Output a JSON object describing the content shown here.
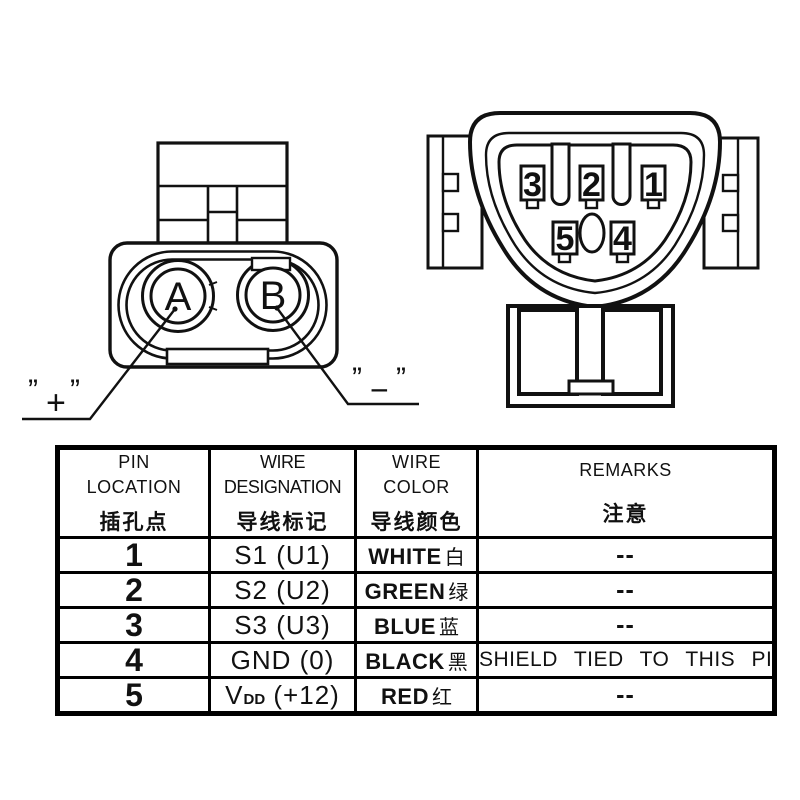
{
  "connector_2pin": {
    "pin_a": "A",
    "pin_b": "B",
    "positive": {
      "open_quote": "”",
      "sign": "+",
      "close_quote": "”"
    },
    "negative": {
      "open_quote": "”",
      "sign": "−",
      "close_quote": "”"
    }
  },
  "connector_5pin": {
    "pins": [
      "3",
      "2",
      "1",
      "5",
      "4"
    ]
  },
  "table": {
    "headers": [
      {
        "en": "PIN\nLOCATION",
        "zh": "插孔点"
      },
      {
        "en": "WIRE\nDESIGNATION",
        "zh": "导线标记"
      },
      {
        "en": "WIRE\nCOLOR",
        "zh": "导线颜色"
      },
      {
        "en": "REMARKS",
        "zh": "注意"
      }
    ],
    "rows": [
      {
        "pin": "1",
        "designation": "S1 (U1)",
        "designation_sub": "",
        "designation_post": "",
        "color_en": "WHITE",
        "color_zh": "白",
        "remarks": "--"
      },
      {
        "pin": "2",
        "designation": "S2 (U2)",
        "designation_sub": "",
        "designation_post": "",
        "color_en": "GREEN",
        "color_zh": "绿",
        "remarks": "--"
      },
      {
        "pin": "3",
        "designation": "S3 (U3)",
        "designation_sub": "",
        "designation_post": "",
        "color_en": "BLUE",
        "color_zh": "蓝",
        "remarks": "--"
      },
      {
        "pin": "4",
        "designation": "GND (0)",
        "designation_sub": "",
        "designation_post": "",
        "color_en": "BLACK",
        "color_zh": "黑",
        "remarks": "SHIELD TIED TO THIS PIN"
      },
      {
        "pin": "5",
        "designation": "V",
        "designation_sub": "DD",
        "designation_post": " (+12)",
        "color_en": "RED",
        "color_zh": "红",
        "remarks": "--"
      }
    ]
  },
  "ink_color": "#111111"
}
